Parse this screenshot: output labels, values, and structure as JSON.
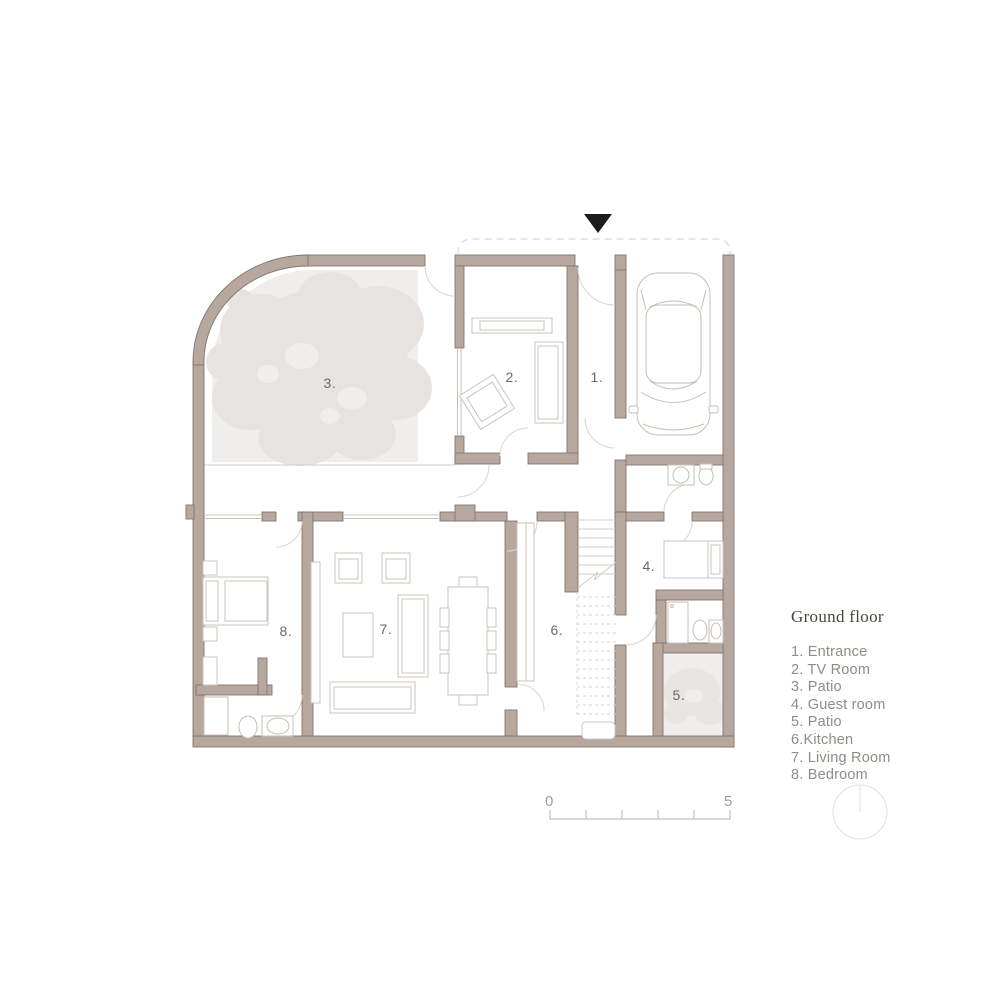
{
  "plan": {
    "room_labels": {
      "r1": "1.",
      "r2": "2.",
      "r3": "3.",
      "r4": "4.",
      "r5": "5.",
      "r6": "6.",
      "r7": "7.",
      "r8": "8."
    }
  },
  "legend": {
    "title": "Ground floor",
    "items": [
      "1. Entrance",
      "2. TV Room",
      "3. Patio",
      "4. Guest room",
      "5. Patio",
      "6.Kitchen",
      "7. Living Room",
      "8. Bedroom"
    ]
  },
  "scale_bar": {
    "start": "0",
    "end": "5"
  },
  "colors": {
    "wall_fill": "#b7a89f",
    "wall_stroke": "#84756b",
    "patio_fill": "#f0eeec",
    "tree_fill": "#e7e3e0",
    "furniture_stroke": "#c9c3bc",
    "door_arc": "#d9d4ce",
    "room_label": "#6e6963",
    "legend_text": "#908c88",
    "north_marker": "#1c1c1c"
  }
}
